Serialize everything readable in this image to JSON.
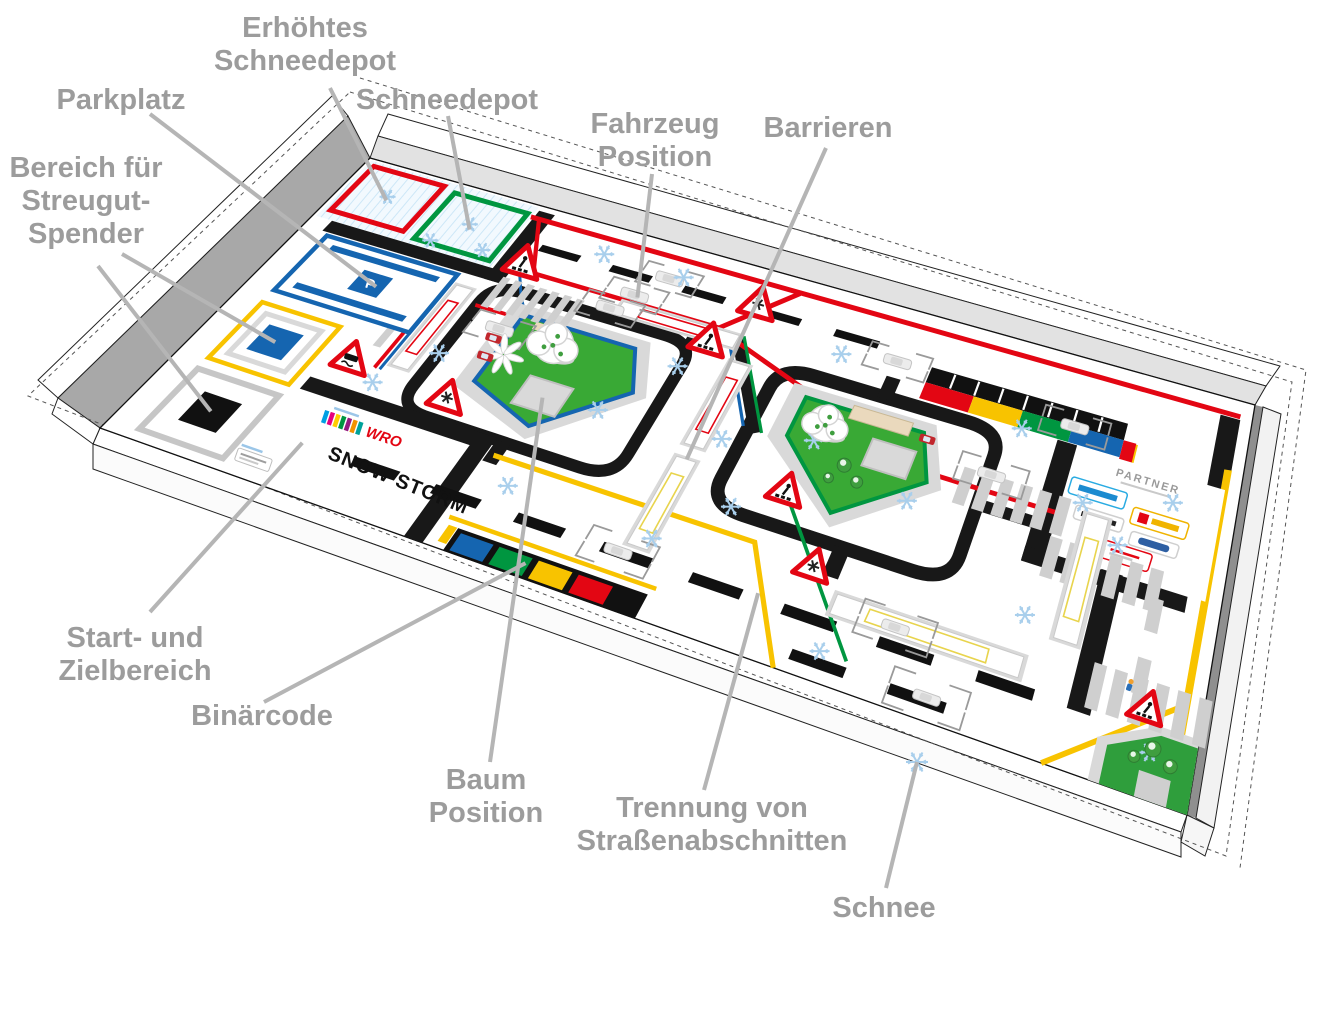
{
  "labels": {
    "erhoehtes": [
      "Erhöhtes",
      "Schneedepot"
    ],
    "parkplatz": [
      "Parkplatz"
    ],
    "schneedepot": [
      "Schneedepot"
    ],
    "bereich": [
      "Bereich für",
      "Streugut-",
      "Spender"
    ],
    "fahrzeug": [
      "Fahrzeug",
      "Position"
    ],
    "barrieren": [
      "Barrieren"
    ],
    "start": [
      "Start- und",
      "Zielbereich"
    ],
    "binaercode": [
      "Binärcode"
    ],
    "baum": [
      "Baum",
      "Position"
    ],
    "trennung": [
      "Trennung von",
      "Straßenabschnitten"
    ],
    "schnee": [
      "Schnee"
    ]
  },
  "mat": {
    "wro": "WRO",
    "snow_storm": "SNOW STORM",
    "parking_symbol": "P",
    "partner_heading": "PARTNER"
  },
  "icons": {
    "snowflake-icon": "six-armed light blue snowflake",
    "warning-sign-snow-icon": "red triangle warning sign with snowflake",
    "warning-sign-pedestrian-icon": "red triangle warning sign with pedestrian crossing",
    "warning-sign-slippery-icon": "red triangle warning sign with skidding car",
    "vehicle-marker-icon": "dashed corner brackets with car silhouette",
    "tree-icon": "snow covered tree",
    "person-icon": "small pedestrian figure"
  },
  "colors": {
    "label_gray": "#9c9c9c",
    "leader_gray": "#b5b5b5",
    "red": "#e30613",
    "green": "#009640",
    "blue": "#1565b0",
    "yellow": "#f8c300",
    "pale_yellow": "#f5e27a",
    "road_black": "#181818",
    "pavement": "#d9d9d9",
    "stripe_gray": "#cfcfcf",
    "lawn": "#39a935",
    "snow_blue": "#a9cfec",
    "wall_dark": "#a8a8a8",
    "wall_light": "#e2e2e2"
  }
}
